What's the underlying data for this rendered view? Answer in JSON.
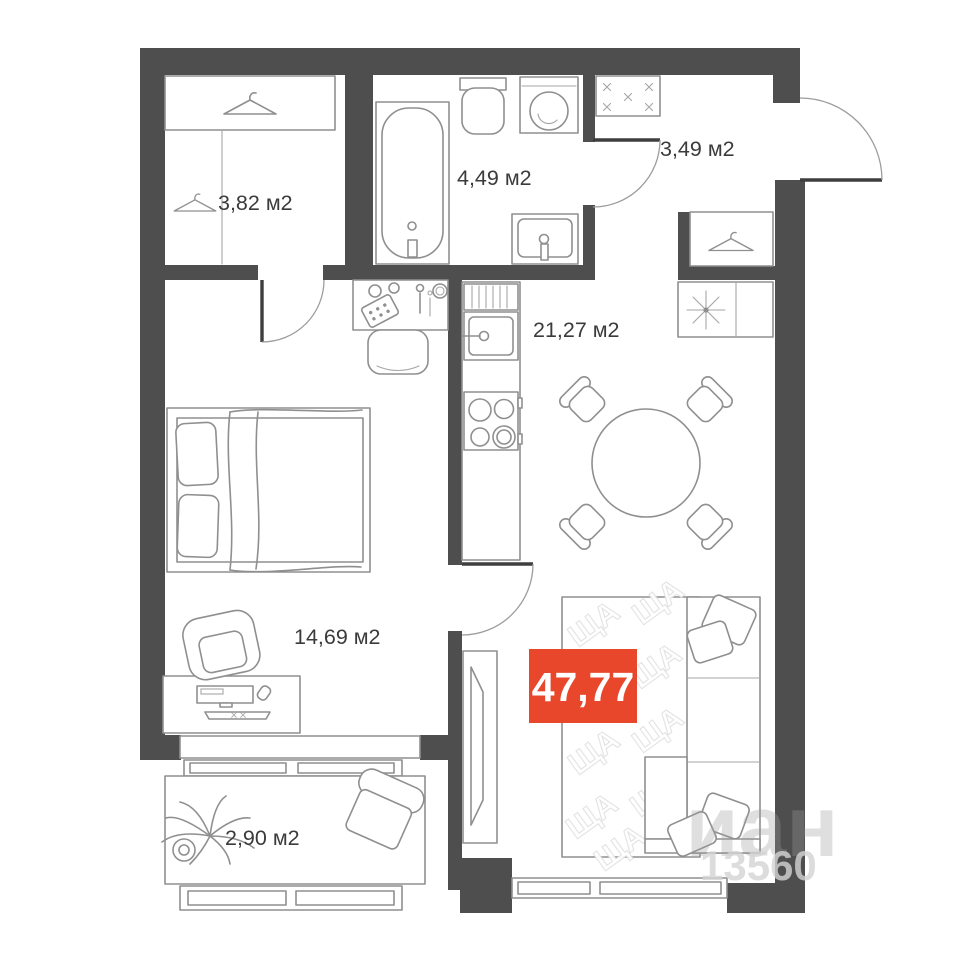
{
  "plan": {
    "colors": {
      "wall": "#4e4e4e",
      "badge": "#e8472b",
      "furniture_line": "#8f8f8f",
      "label_text": "#3b3b3b"
    },
    "rooms": [
      {
        "id": "wardrobe",
        "area_label": "3,82 м2"
      },
      {
        "id": "bathroom",
        "area_label": "4,49 м2"
      },
      {
        "id": "hallway",
        "area_label": "3,49 м2"
      },
      {
        "id": "kitchen_living",
        "area_label": "21,27 м2"
      },
      {
        "id": "bedroom",
        "area_label": "14,69 м2"
      },
      {
        "id": "balcony",
        "area_label": "2,90 м2"
      }
    ],
    "total_area_badge": {
      "value": "47,77",
      "color": "#e8472b"
    },
    "watermarks": {
      "pattern": "ЩА",
      "brand": "иан",
      "number": "13560"
    },
    "icons": {
      "hanger": "clothes-hanger",
      "star8": "ventilation-star",
      "xmark": "doormat-cross",
      "plant": "potted-plant"
    }
  }
}
